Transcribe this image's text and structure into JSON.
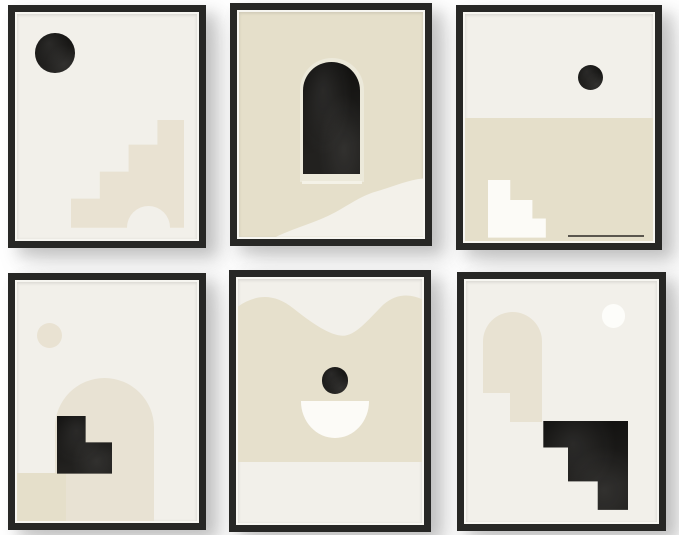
{
  "product_gallery": {
    "description": "Set of 6 black-framed abstract mid-century minimalist art prints hung in two rows of three on a white wall",
    "rows": 2,
    "columns": 3,
    "wall_color": "#ffffff",
    "frame_color": "#272725"
  },
  "palette": {
    "cream": "#f2f0ea",
    "beige": "#e5dfca",
    "beige_light": "#e9e2d2",
    "ink": "#161513",
    "paper_white": "#fcfbf7",
    "frame": "#272725",
    "line": "#5a564e"
  },
  "prints": [
    {
      "id": 1,
      "row": 1,
      "col": 1,
      "background": "#f2f0ea",
      "alt": "Black sun circle above a beige ascending staircase with an arched doorway cutout",
      "shapes": [
        "black-circle",
        "beige-staircase",
        "cream-arch-cutout"
      ]
    },
    {
      "id": 2,
      "row": 1,
      "col": 2,
      "background": "#e5dfca",
      "alt": "Textured black arched doorway on beige with cream underline and cream dune at bottom right",
      "shapes": [
        "black-arch",
        "cream-underline",
        "cream-dune"
      ]
    },
    {
      "id": 3,
      "row": 1,
      "col": 3,
      "background": "#f2f0ea",
      "alt": "Black sun over a beige horizon field with white descending steps and a thin dark line",
      "shapes": [
        "black-circle",
        "beige-ground",
        "white-staircase",
        "dark-line"
      ]
    },
    {
      "id": 4,
      "row": 2,
      "col": 1,
      "background": "#f2f0ea",
      "alt": "Beige sun and tall beige arch with black stepped blocks on a beige ground strip",
      "shapes": [
        "beige-circle",
        "beige-arch",
        "black-steps",
        "beige-ground"
      ]
    },
    {
      "id": 5,
      "row": 2,
      "col": 2,
      "background": "#f2f0ea",
      "alt": "Beige wavy dune mass with black sun circle above a white bowl semicircle",
      "shapes": [
        "beige-wave-mass",
        "black-circle",
        "white-bowl"
      ]
    },
    {
      "id": 6,
      "row": 2,
      "col": 3,
      "background": "#f2f0ea",
      "alt": "White moon circle, stepped beige arch column and black descending staircase",
      "shapes": [
        "white-circle",
        "beige-arch",
        "beige-column",
        "black-staircase"
      ]
    }
  ]
}
